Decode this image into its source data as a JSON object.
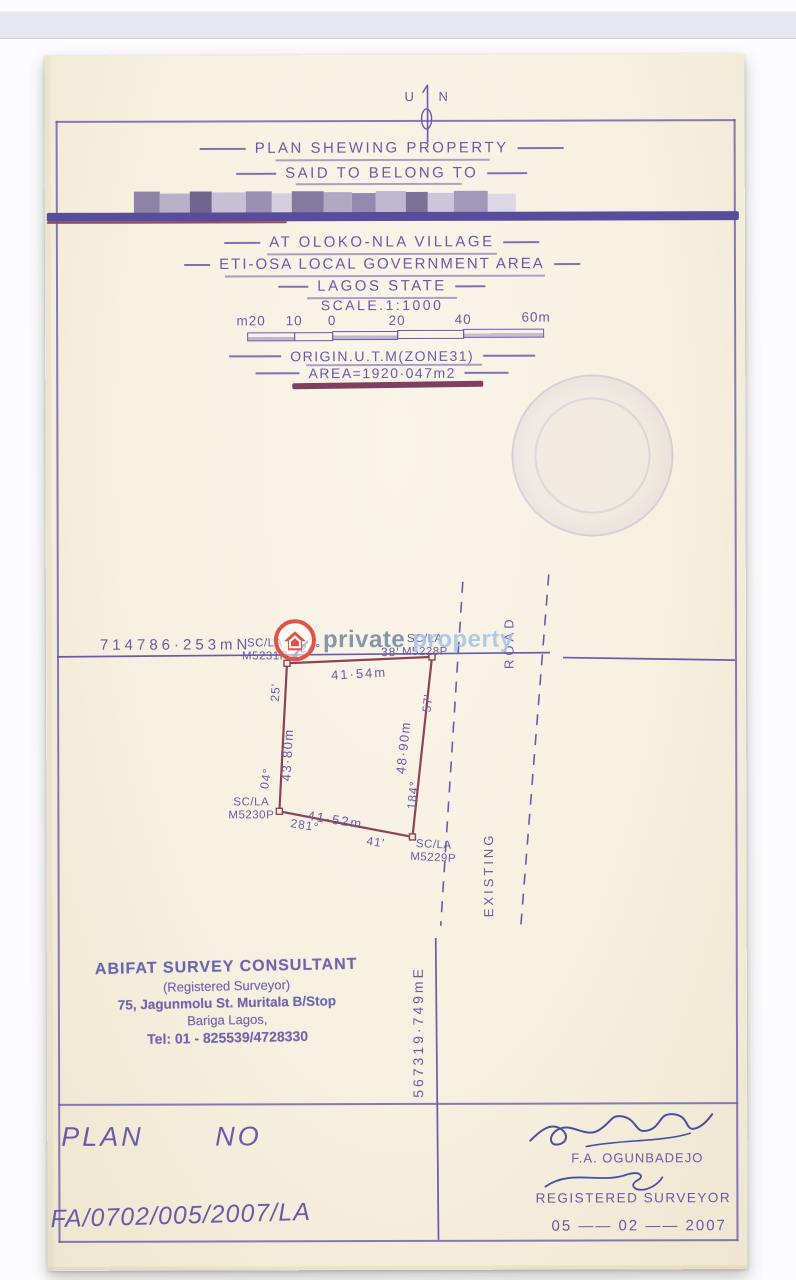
{
  "colors": {
    "ink": "#675caa",
    "parcel_line": "#8e4157",
    "redaction_bar": "#584d9d",
    "watermark_red": "#dd5448",
    "watermark_gray_blue": "#7d90a9",
    "watermark_light_blue": "#a6c8ea",
    "signature_ink": "#4a4f9f",
    "consultant_stamp": "#5b53a8"
  },
  "compass": {
    "left_letter": "U",
    "right_letter": "N"
  },
  "header": {
    "title": "PLAN SHEWING PROPERTY",
    "subtitle": "SAID TO BELONG TO",
    "location1": "AT OLOKO-NLA VILLAGE",
    "location2": "ETI-OSA LOCAL GOVERNMENT AREA",
    "location3": "LAGOS STATE",
    "scale": "SCALE.1:1000"
  },
  "scale_bar": {
    "labels": [
      "m20",
      "10",
      "0",
      "20",
      "40",
      "60m"
    ]
  },
  "meta": {
    "origin": "ORIGIN.U.T.M(ZONE31)",
    "area": "AREA=1920·047m2"
  },
  "watermark": {
    "word1": "private",
    "word2": "property"
  },
  "grid": {
    "northing": "714786·253mN",
    "easting": "567319·749mE"
  },
  "parcel": {
    "corners": [
      {
        "line1": "SC/LA",
        "line2": "M5231P"
      },
      {
        "line1": "SC/LA",
        "line2": "M5228P"
      },
      {
        "line1": "SC/LA",
        "line2": "M5229P"
      },
      {
        "line1": "SC/LA",
        "line2": "M5230P"
      }
    ],
    "edges": {
      "top": {
        "length": "41·54m",
        "bearing_deg": "24°",
        "bearing_min": "38'"
      },
      "right": {
        "length": "48·90m",
        "bearing_deg": "184°",
        "bearing_min": "57'"
      },
      "bottom": {
        "length": "41·52m",
        "bearing_deg": "281°",
        "bearing_min": "41'"
      },
      "left": {
        "length": "43·80m",
        "bearing_deg": "04°",
        "bearing_min": "25'"
      }
    }
  },
  "road": {
    "word1": "EXISTING",
    "word2": "ROAD"
  },
  "consultant": {
    "line1": "ABIFAT SURVEY CONSULTANT",
    "line2": "(Registered  Surveyor)",
    "line3": "75, Jagunmolu St. Muritala B/Stop",
    "line4": "Bariga  Lagos,",
    "line5": "Tel: 01 - 825539/4728330"
  },
  "footer": {
    "plan_label": "PLAN",
    "no_label": "NO",
    "plan_number": "FA/0702/005/2007/LA",
    "surveyor_name": "F.A. OGUNBADEJO",
    "surveyor_title": "REGISTERED SURVEYOR",
    "date": "05 —— 02 —— 2007"
  }
}
